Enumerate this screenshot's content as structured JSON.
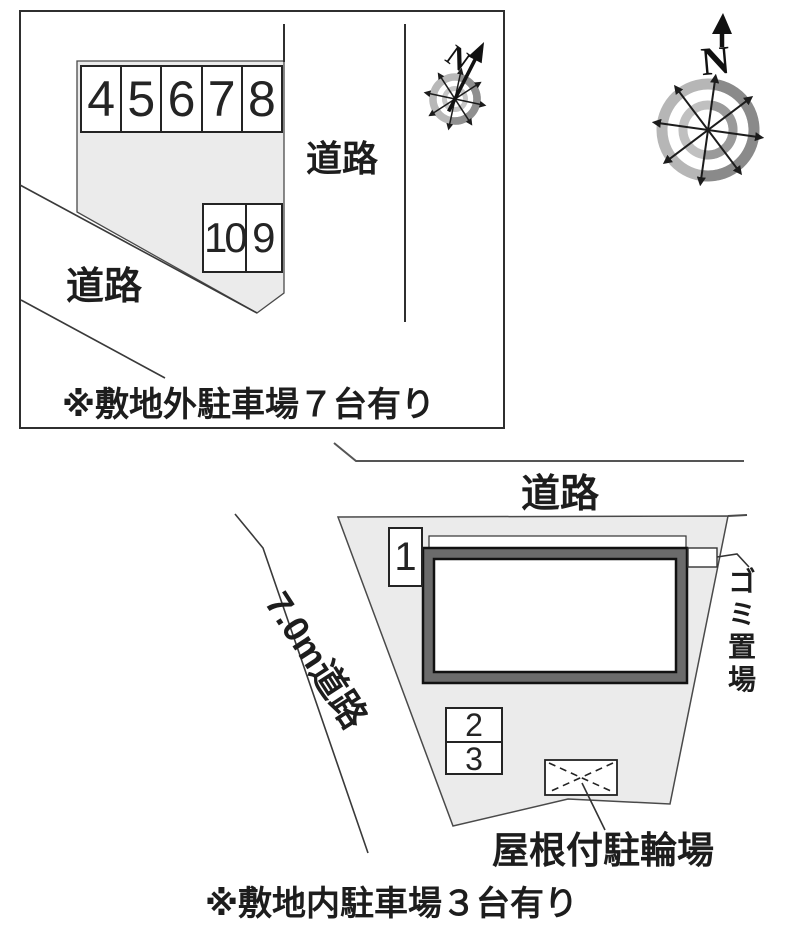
{
  "colors": {
    "line": "#2f2f2f",
    "lot_fill": "#ebebeb",
    "building_gray": "#6b6b6b",
    "compass_ring_light": "#b6b6b6",
    "compass_ring_dark": "#8a8a8a"
  },
  "offsite_plan": {
    "road_label_right": "道路",
    "road_label_bottom": "道路",
    "parking_row_upper": [
      "4",
      "5",
      "6",
      "7",
      "8"
    ],
    "parking_row_lower": [
      "10",
      "9"
    ],
    "note": "※敷地外駐車場７台有り",
    "compass_north": "N"
  },
  "main_compass": {
    "north_label": "N"
  },
  "site_plan": {
    "road_label_top": "道路",
    "road_label_left": "7.0m道路",
    "parking_space_1": "1",
    "parking_space_2": "2",
    "parking_space_3": "3",
    "garbage_area_label": "ゴミ置場",
    "bicycle_parking_label": "屋根付駐輪場",
    "note": "※敷地内駐車場３台有り"
  }
}
